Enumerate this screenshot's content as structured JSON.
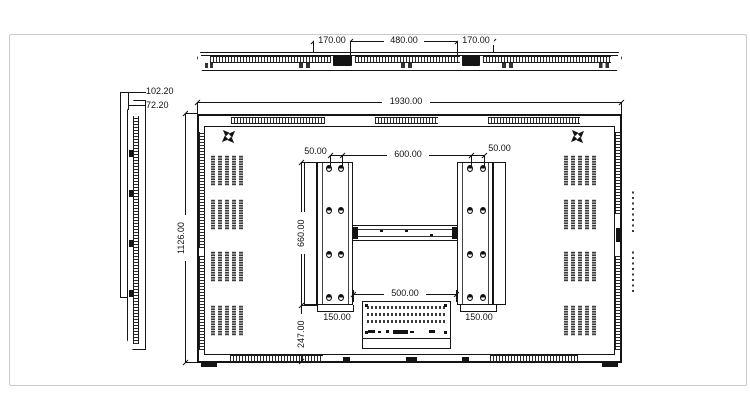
{
  "meta": {
    "drawing_type": "flat-panel display engineering drawing (top, side and rear views)",
    "units": "mm"
  },
  "colors": {
    "line": "#141414",
    "background": "#ffffff",
    "frame": "#cbcbcb"
  },
  "side_view": {
    "depth_total": "102.20",
    "depth_body": "72.20"
  },
  "top_view": {
    "dim_left": "170.00",
    "dim_center": "480.00",
    "dim_right": "170.00"
  },
  "rear_view": {
    "overall_width": "1930.00",
    "overall_height": "1126.00",
    "hole_pitch_left": "50.00",
    "hole_span_center": "600.00",
    "hole_pitch_right": "50.00",
    "bracket_height": "660.00",
    "bottom_offset": "247.00",
    "rail_gap": "500.00",
    "bracket_width_left": "150.00",
    "bracket_width_right": "150.00"
  }
}
